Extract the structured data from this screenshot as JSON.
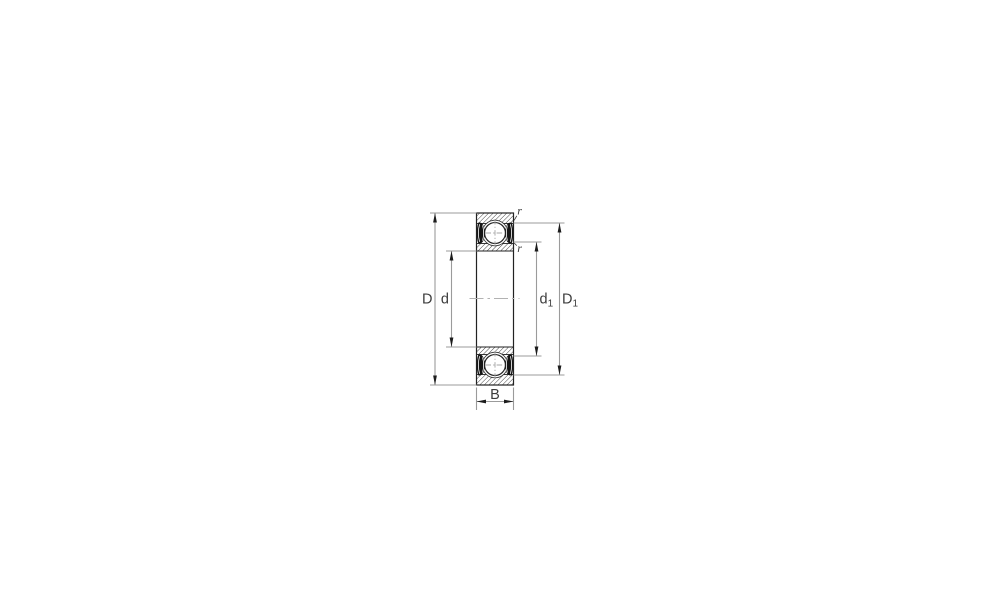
{
  "figure": {
    "labels": {
      "D": "D",
      "d": "d",
      "d1": {
        "base": "d",
        "sub": "1"
      },
      "D1": {
        "base": "D",
        "sub": "1"
      },
      "B": "B",
      "r_top": "r",
      "r_bottom": "r"
    },
    "colors": {
      "background": "#ffffff",
      "outline": "#222222",
      "hatch": "#2a2a2a",
      "seal": "#151515",
      "dimension_line": "#9b9b9b",
      "arrow": "#1c1c1c",
      "label": "#3c3c3c",
      "centerline": "#b2b2b2"
    }
  }
}
